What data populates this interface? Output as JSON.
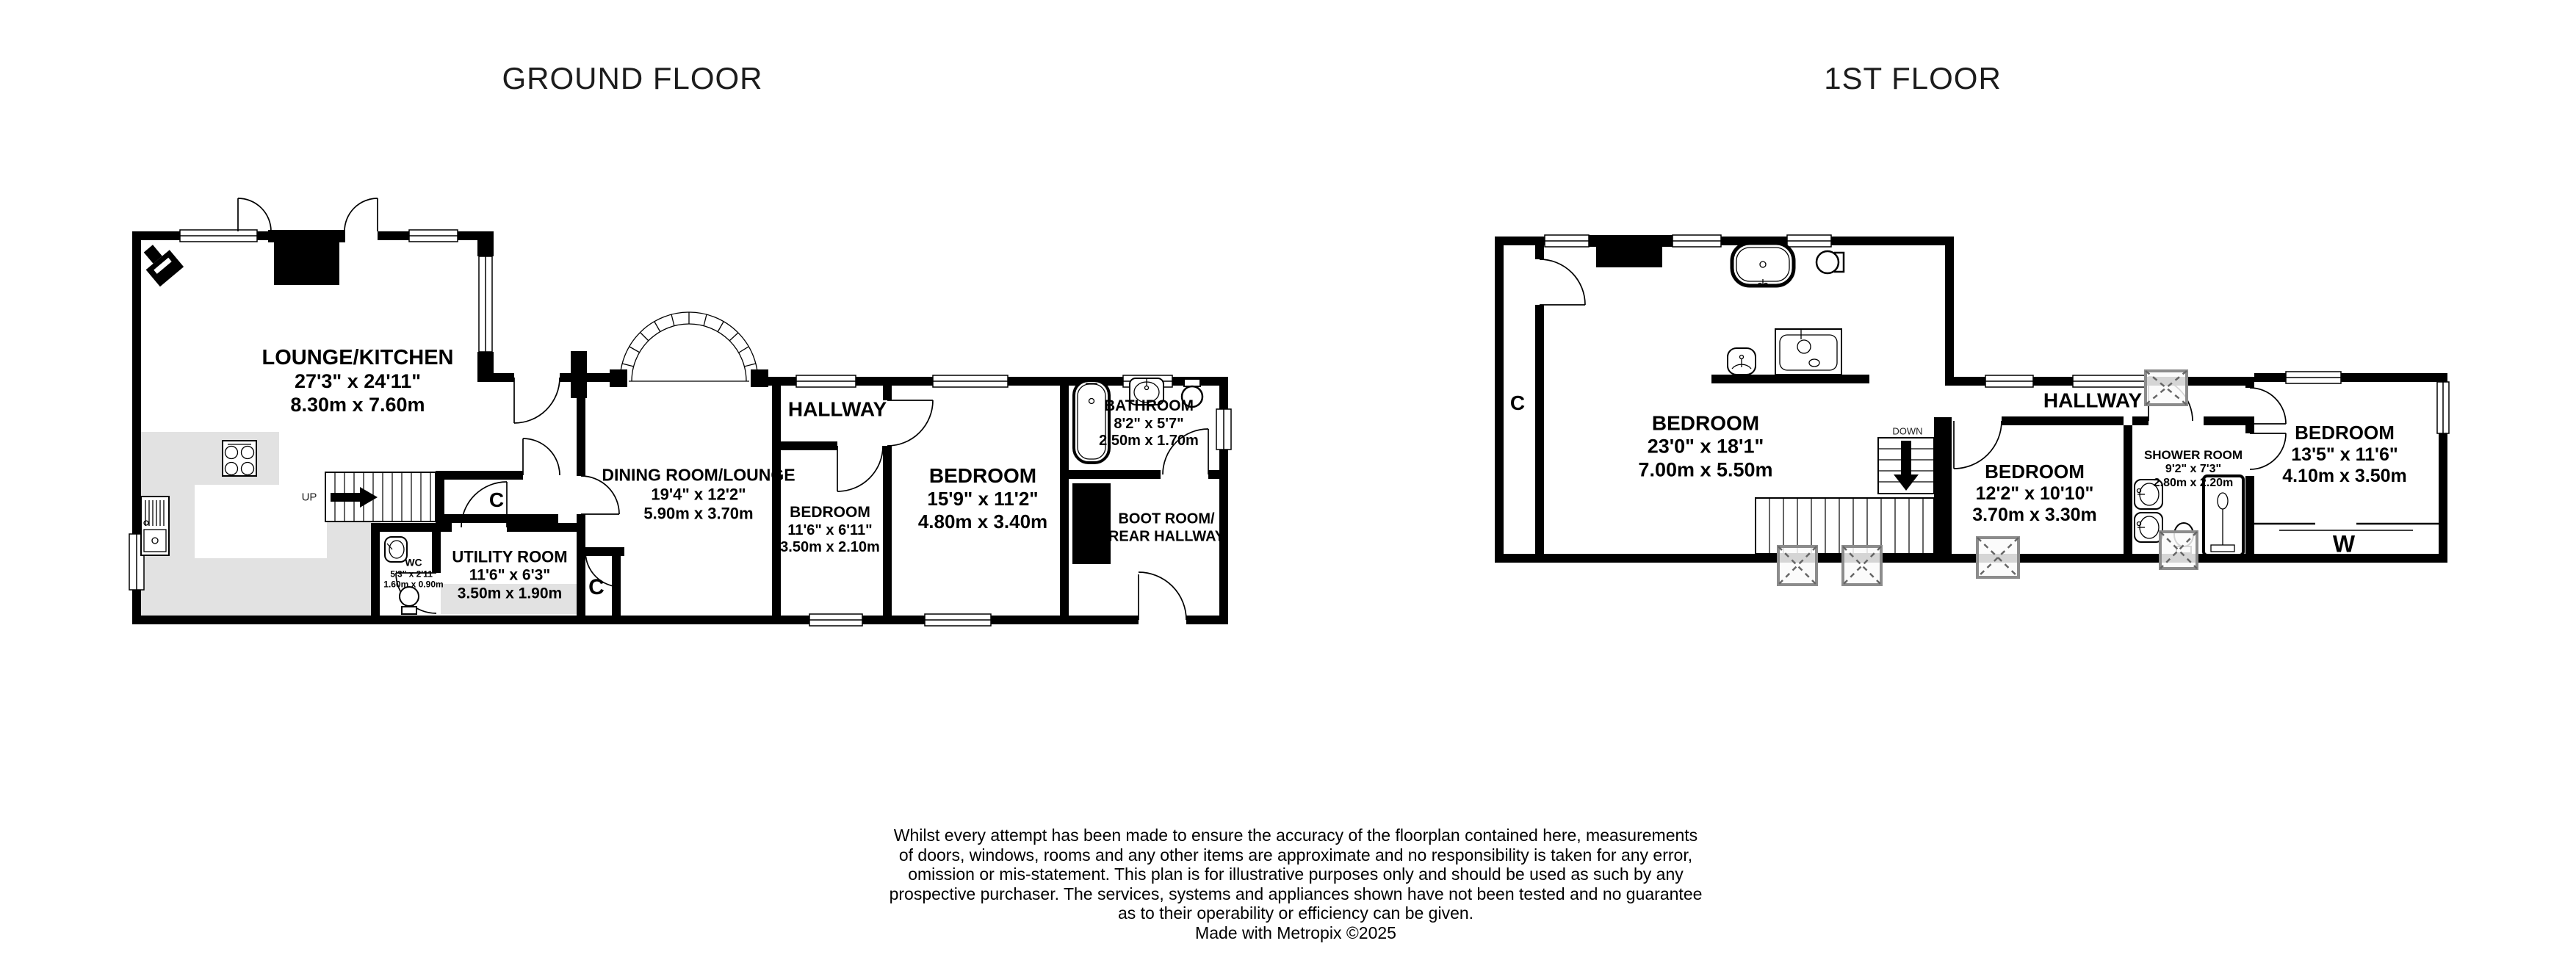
{
  "titles": {
    "ground": "GROUND FLOOR",
    "first": "1ST FLOOR"
  },
  "colors": {
    "wall": "#000000",
    "kitchen_floor": "#e2e2e2",
    "skylight_frame": "#8c8c8c",
    "text": "#000000"
  },
  "ground": {
    "lounge_kitchen": {
      "name": "LOUNGE/KITCHEN",
      "imperial": "27'3\"  x 24'11\"",
      "metric": "8.30m  x 7.60m"
    },
    "dining_room": {
      "name": "DINING ROOM/LOUNGE",
      "imperial": "19'4\"  x 12'2\"",
      "metric": "5.90m  x 3.70m"
    },
    "hallway": {
      "name": "HALLWAY"
    },
    "bedroom_small": {
      "name": "BEDROOM",
      "imperial": "11'6\"  x 6'11\"",
      "metric": "3.50m  x 2.10m"
    },
    "bedroom_main": {
      "name": "BEDROOM",
      "imperial": "15'9\"  x 11'2\"",
      "metric": "4.80m  x 3.40m"
    },
    "bathroom": {
      "name": "BATHROOM",
      "imperial": "8'2\"  x 5'7\"",
      "metric": "2.50m  x 1.70m"
    },
    "boot_room": {
      "line1": "BOOT ROOM/",
      "line2": "REAR HALLWAY"
    },
    "wc": {
      "name": "WC",
      "imperial": "5'3\"  x 2'11\"",
      "metric": "1.60m  x 0.90m"
    },
    "utility_room": {
      "name": "UTILITY ROOM",
      "imperial": "11'6\"  x 6'3\"",
      "metric": "3.50m  x 1.90m"
    },
    "closet_label": "C",
    "closet2_label": "C",
    "stairs_up": "UP"
  },
  "first": {
    "bedroom_1": {
      "name": "BEDROOM",
      "imperial": "23'0\"  x 18'1\"",
      "metric": "7.00m  x 5.50m"
    },
    "hallway": {
      "name": "HALLWAY"
    },
    "bedroom_2": {
      "name": "BEDROOM",
      "imperial": "12'2\"  x 10'10\"",
      "metric": "3.70m  x 3.30m"
    },
    "shower_room": {
      "name": "SHOWER ROOM",
      "imperial": "9'2\"  x 7'3\"",
      "metric": "2.80m  x 2.20m"
    },
    "bedroom_3": {
      "name": "BEDROOM",
      "imperial": "13'5\"  x 11'6\"",
      "metric": "4.10m  x 3.50m"
    },
    "closet_label": "C",
    "wardrobe_label": "W",
    "stairs_down": "DOWN"
  },
  "disclaimer": {
    "line1": "Whilst every attempt has been made to ensure the accuracy of the floorplan contained here, measurements",
    "line2": "of doors, windows, rooms and any other items are approximate and no responsibility is taken for any error,",
    "line3": "omission or mis-statement. This plan is for illustrative purposes only and should be used as such by any",
    "line4": "prospective purchaser. The services, systems and appliances shown have not been tested and no guarantee",
    "line5": "as to their operability or efficiency can be given.",
    "credit": "Made with Metropix ©2025"
  }
}
